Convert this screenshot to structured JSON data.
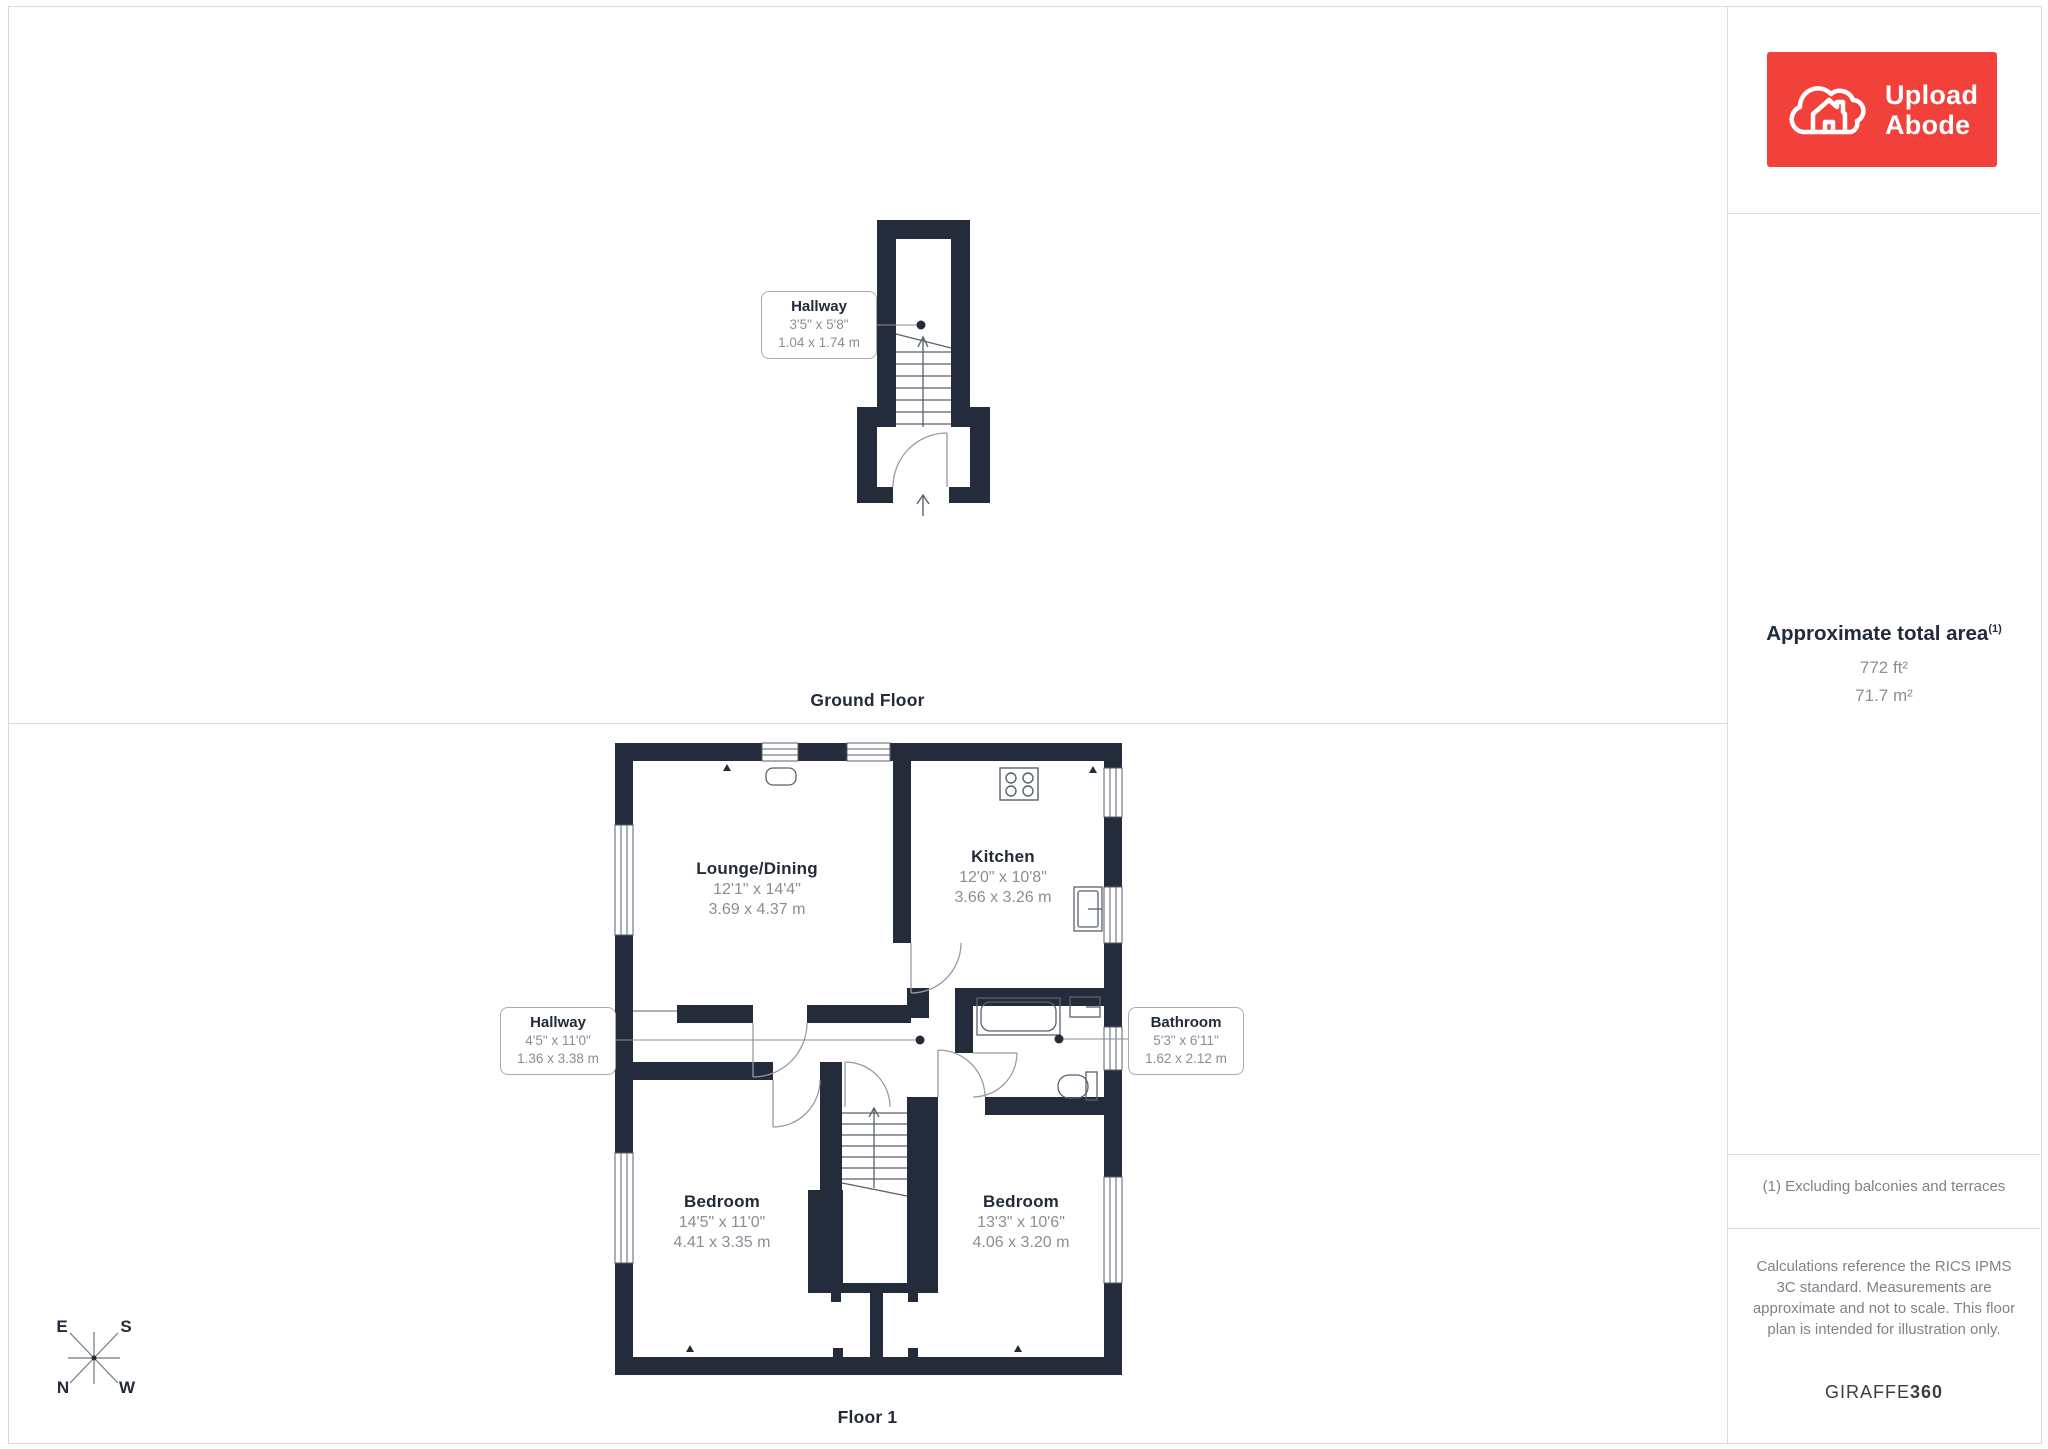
{
  "branding": {
    "logo_line1": "Upload",
    "logo_line2": "Abode",
    "watermark_regular": "GIRAFFE",
    "watermark_bold": "360"
  },
  "sidebar": {
    "area_title": "Approximate total area",
    "area_superscript": "(1)",
    "area_ft": "772 ft²",
    "area_m": "71.7 m²",
    "footnote": "(1) Excluding balconies and terraces",
    "disclaimer": "Calculations reference the RICS IPMS 3C standard. Measurements are approximate and not to scale. This floor plan is intended for illustration only."
  },
  "floors": {
    "ground": {
      "label": "Ground Floor",
      "hallway": {
        "name": "Hallway",
        "imperial": "3'5\" x 5'8\"",
        "metric": "1.04 x 1.74 m"
      }
    },
    "first": {
      "label": "Floor 1",
      "lounge": {
        "name": "Lounge/Dining",
        "imperial": "12'1\" x 14'4\"",
        "metric": "3.69 x 4.37 m"
      },
      "kitchen": {
        "name": "Kitchen",
        "imperial": "12'0\" x 10'8\"",
        "metric": "3.66 x 3.26 m"
      },
      "hallway": {
        "name": "Hallway",
        "imperial": "4'5\" x 11'0\"",
        "metric": "1.36 x 3.38 m"
      },
      "bathroom": {
        "name": "Bathroom",
        "imperial": "5'3\" x 6'11\"",
        "metric": "1.62 x 2.12 m"
      },
      "bedroom_left": {
        "name": "Bedroom",
        "imperial": "14'5\" x 11'0\"",
        "metric": "4.41 x 3.35 m"
      },
      "bedroom_right": {
        "name": "Bedroom",
        "imperial": "13'3\" x 10'6\"",
        "metric": "4.06 x 3.20 m"
      }
    }
  },
  "compass": {
    "n": "N",
    "e": "E",
    "s": "S",
    "w": "W"
  },
  "colors": {
    "wall": "#242C3B",
    "accent_red": "#F2413A",
    "text_dark": "#232B3A",
    "text_gray": "#8A8E95",
    "divider": "#DDDDDD"
  }
}
